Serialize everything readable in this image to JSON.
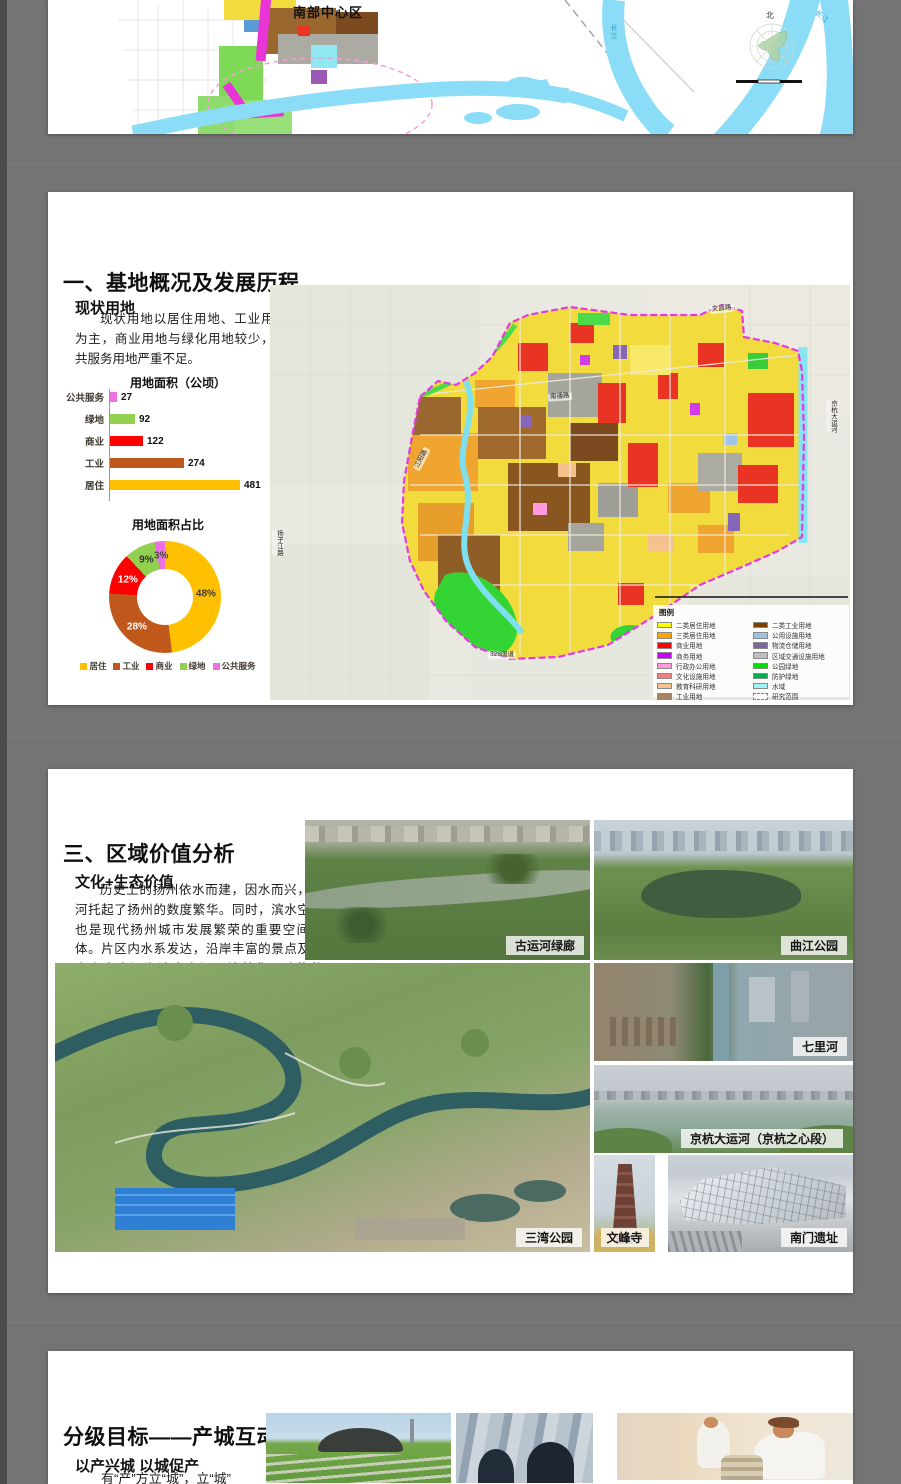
{
  "page": {
    "background": "#747474",
    "page_color": "#ffffff"
  },
  "slide1": {
    "region_label": "南部中心区",
    "compass_label": "北",
    "river_label": "长江"
  },
  "slide2": {
    "title": "一、基地概况及发展历程",
    "section": "现状用地",
    "paragraph": "现状用地以居住用地、工业用地为主，商业用地与绿化用地较少，公共服务用地严重不足。",
    "map": {
      "legend_title": "图例",
      "legend_left": [
        {
          "label": "二类居住用地",
          "color": "#ffff00"
        },
        {
          "label": "三类居住用地",
          "color": "#ffa500"
        },
        {
          "label": "商业用地",
          "color": "#ff0000"
        },
        {
          "label": "商务用地",
          "color": "#cc00ff"
        },
        {
          "label": "行政办公用地",
          "color": "#ff99dd"
        },
        {
          "label": "文化设施用地",
          "color": "#f08080"
        },
        {
          "label": "教育科研用地",
          "color": "#f5c28d"
        },
        {
          "label": "工业用地",
          "color": "#a9825f"
        }
      ],
      "legend_right": [
        {
          "label": "二类工业用地",
          "color": "#7b3f00"
        },
        {
          "label": "公用设施用地",
          "color": "#9dc3e6"
        },
        {
          "label": "物流仓储用地",
          "color": "#8064a2"
        },
        {
          "label": "区域交通设施用地",
          "color": "#bfbfbf"
        },
        {
          "label": "公园绿地",
          "color": "#00e000"
        },
        {
          "label": "防护绿地",
          "color": "#00b050"
        },
        {
          "label": "水域",
          "color": "#9ff3f9"
        },
        {
          "label": "研究范围",
          "color": "dashed"
        }
      ],
      "road_labels": [
        "文昌路",
        "南通路",
        "江阳路",
        "扬子江路",
        "京杭大运河",
        "328国道"
      ]
    }
  },
  "slide3": {
    "title": "三、区域价值分析",
    "section": "文化+生态价值",
    "paragraph": "历史上的扬州依水而建，因水而兴，运河托起了扬州的数度繁华。同时，滨水空间也是现代扬州城市发展繁荣的重要空间载体。片区内水系发达，沿岸丰富的景点及历史人文资源为滨水空间环境美化、功能整合、形象塑造提供了优良的基础。",
    "photos": [
      {
        "label": "古运河绿廊"
      },
      {
        "label": "曲江公园"
      },
      {
        "label": "三湾公园"
      },
      {
        "label": "七里河"
      },
      {
        "label": "京杭大运河（京杭之心段）"
      },
      {
        "label": "文峰寺"
      },
      {
        "label": "南门遗址"
      }
    ]
  },
  "slide4": {
    "title": "分级目标——产城互动",
    "section": "以产兴城 以城促产",
    "partial_text": "有“产”方立“城”，立“城”"
  },
  "chart_data": [
    {
      "type": "bar",
      "orientation": "horizontal",
      "title": "用地面积（公顷）",
      "categories": [
        "公共服务",
        "绿地",
        "商业",
        "工业",
        "居住"
      ],
      "values": [
        27,
        92,
        122,
        274,
        481
      ],
      "colors": [
        "#ee6fe1",
        "#92d050",
        "#ff0000",
        "#c0571b",
        "#ffc000"
      ],
      "xlim": [
        0,
        500
      ],
      "grid": false
    },
    {
      "type": "pie",
      "subtype": "donut",
      "title": "用地面积占比",
      "categories": [
        "居住",
        "工业",
        "商业",
        "绿地",
        "公共服务"
      ],
      "values": [
        48,
        28,
        12,
        9,
        3
      ],
      "unit": "%",
      "colors": [
        "#ffc000",
        "#c0571b",
        "#ff0000",
        "#92d050",
        "#ee6fe1"
      ],
      "legend_position": "bottom"
    }
  ]
}
